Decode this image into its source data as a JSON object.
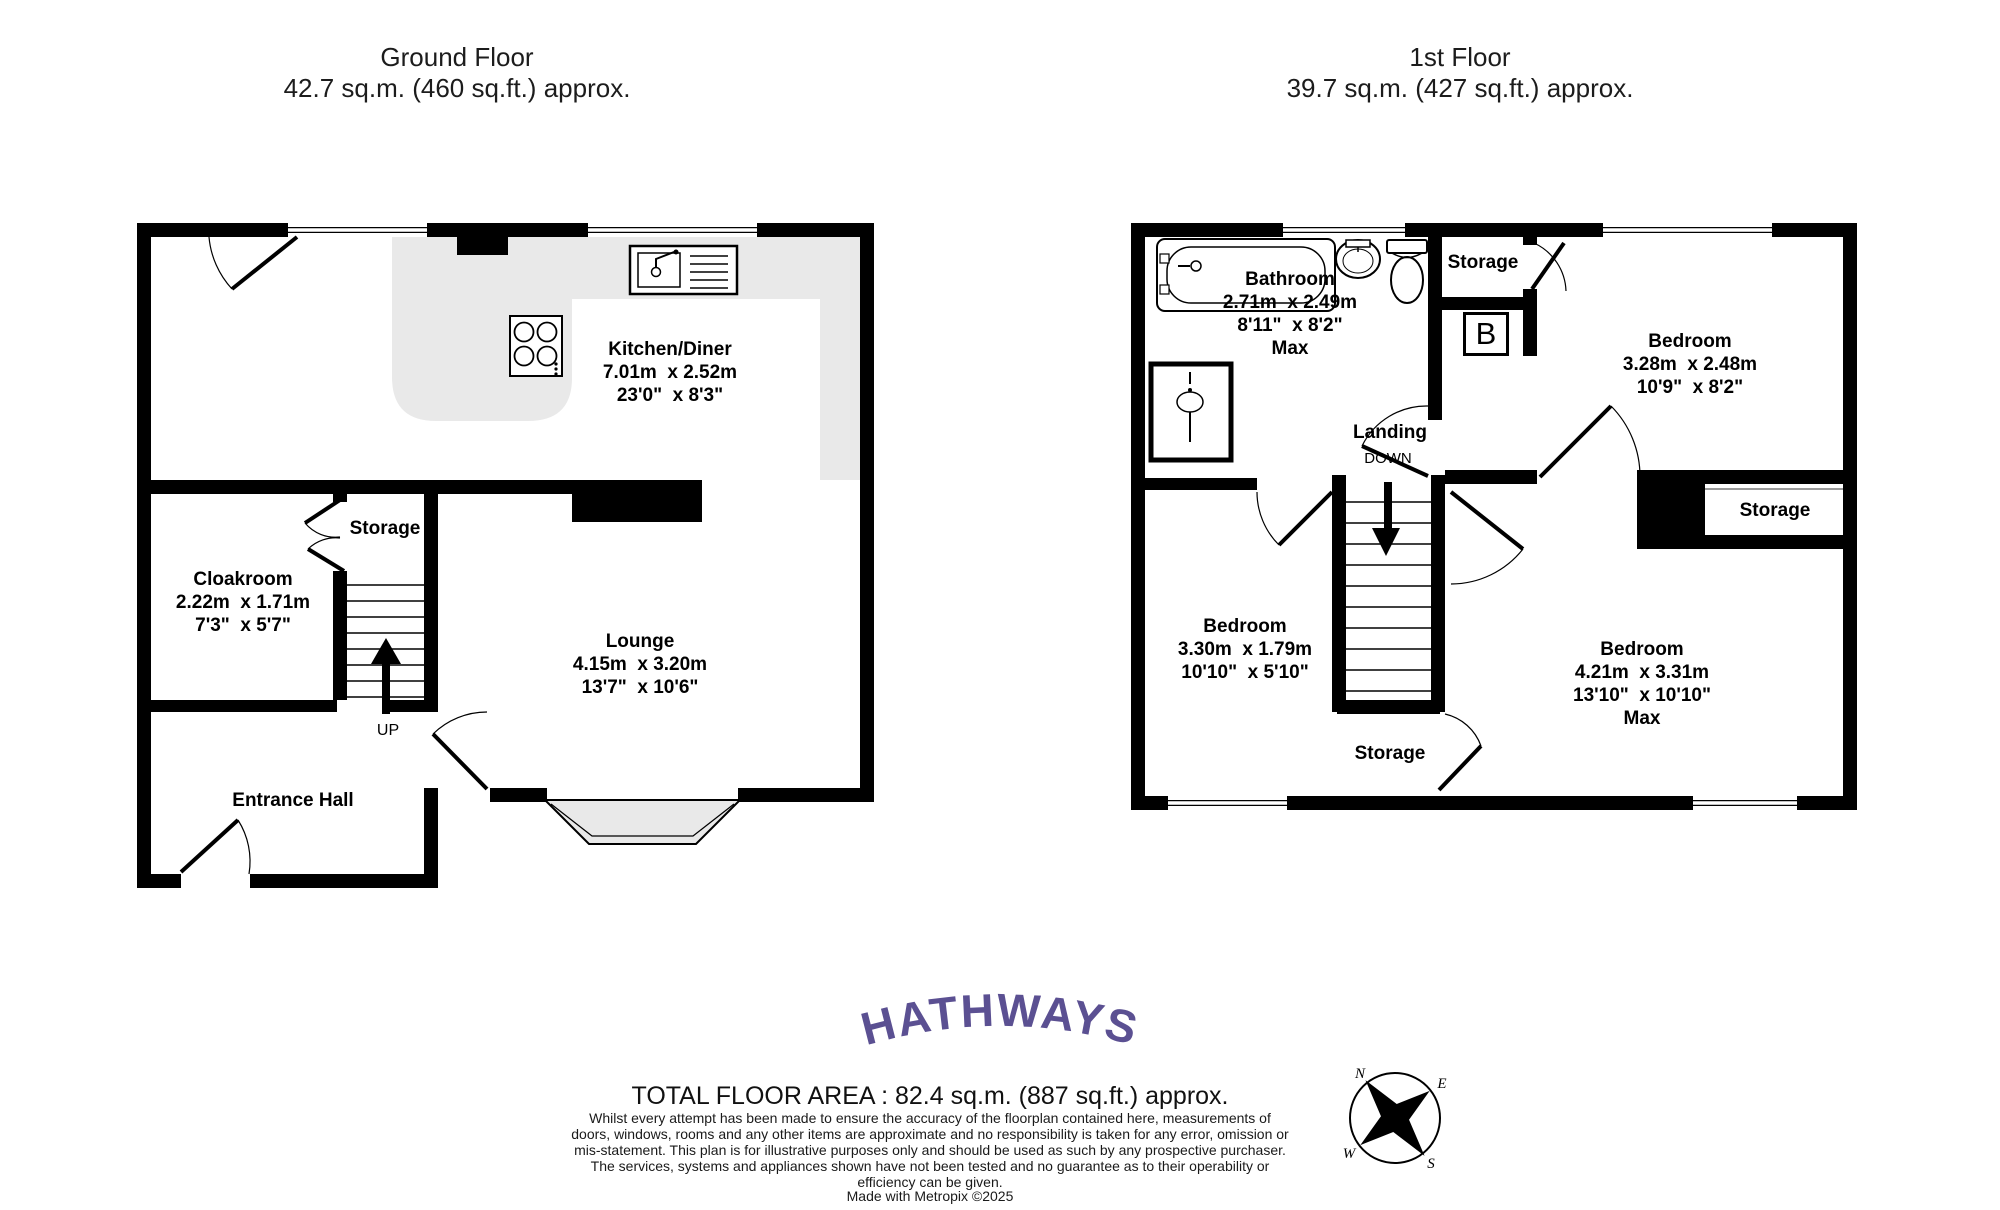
{
  "ground_floor": {
    "title": "Ground Floor",
    "area": "42.7 sq.m. (460 sq.ft.) approx.",
    "rooms": {
      "kitchen_diner": {
        "name": "Kitchen/Diner",
        "metric": "7.01m  x 2.52m",
        "imperial": "23'0\"  x 8'3\""
      },
      "cloakroom": {
        "name": "Cloakroom",
        "metric": "2.22m  x 1.71m",
        "imperial": "7'3\"  x 5'7\""
      },
      "lounge": {
        "name": "Lounge",
        "metric": "4.15m  x 3.20m",
        "imperial": "13'7\"  x 10'6\""
      },
      "entrance_hall": {
        "name": "Entrance Hall"
      },
      "storage": {
        "name": "Storage"
      }
    },
    "stairs_label": "UP"
  },
  "first_floor": {
    "title": "1st Floor",
    "area": "39.7 sq.m. (427 sq.ft.) approx.",
    "rooms": {
      "bathroom": {
        "name": "Bathroom",
        "metric": "2.71m  x 2.49m",
        "imperial": "8'11\"  x 8'2\"",
        "qualifier": "Max"
      },
      "bedroom_top_right": {
        "name": "Bedroom",
        "metric": "3.28m  x 2.48m",
        "imperial": "10'9\"  x 8'2\""
      },
      "bedroom_left": {
        "name": "Bedroom",
        "metric": "3.30m  x 1.79m",
        "imperial": "10'10\"  x 5'10\""
      },
      "bedroom_bottom_right": {
        "name": "Bedroom",
        "metric": "4.21m  x 3.31m",
        "imperial": "13'10\"  x 10'10\"",
        "qualifier": "Max"
      },
      "landing": {
        "name": "Landing"
      },
      "storage_top": {
        "name": "Storage"
      },
      "storage_right": {
        "name": "Storage"
      },
      "storage_bottom": {
        "name": "Storage"
      }
    },
    "stairs_label": "DOWN",
    "boiler_label": "B"
  },
  "footer": {
    "logo": "HATHWAYS",
    "total_area": "TOTAL FLOOR AREA : 82.4 sq.m. (887 sq.ft.) approx.",
    "disclaimer": "Whilst every attempt has been made to ensure the accuracy of the floorplan contained here, measurements of doors, windows, rooms and any other items are approximate and no responsibility is taken for any error, omission or mis-statement. This plan is for illustrative purposes only and should be used as such by any prospective purchaser. The services, systems and appliances shown have not been tested and no guarantee as to their operability or efficiency can be given.",
    "credit": "Made with Metropix ©2025",
    "compass": {
      "n": "N",
      "e": "E",
      "s": "S",
      "w": "W"
    }
  },
  "colors": {
    "wall": "#000000",
    "floor_highlight": "#e9e9e9",
    "logo": "#5b5092"
  }
}
